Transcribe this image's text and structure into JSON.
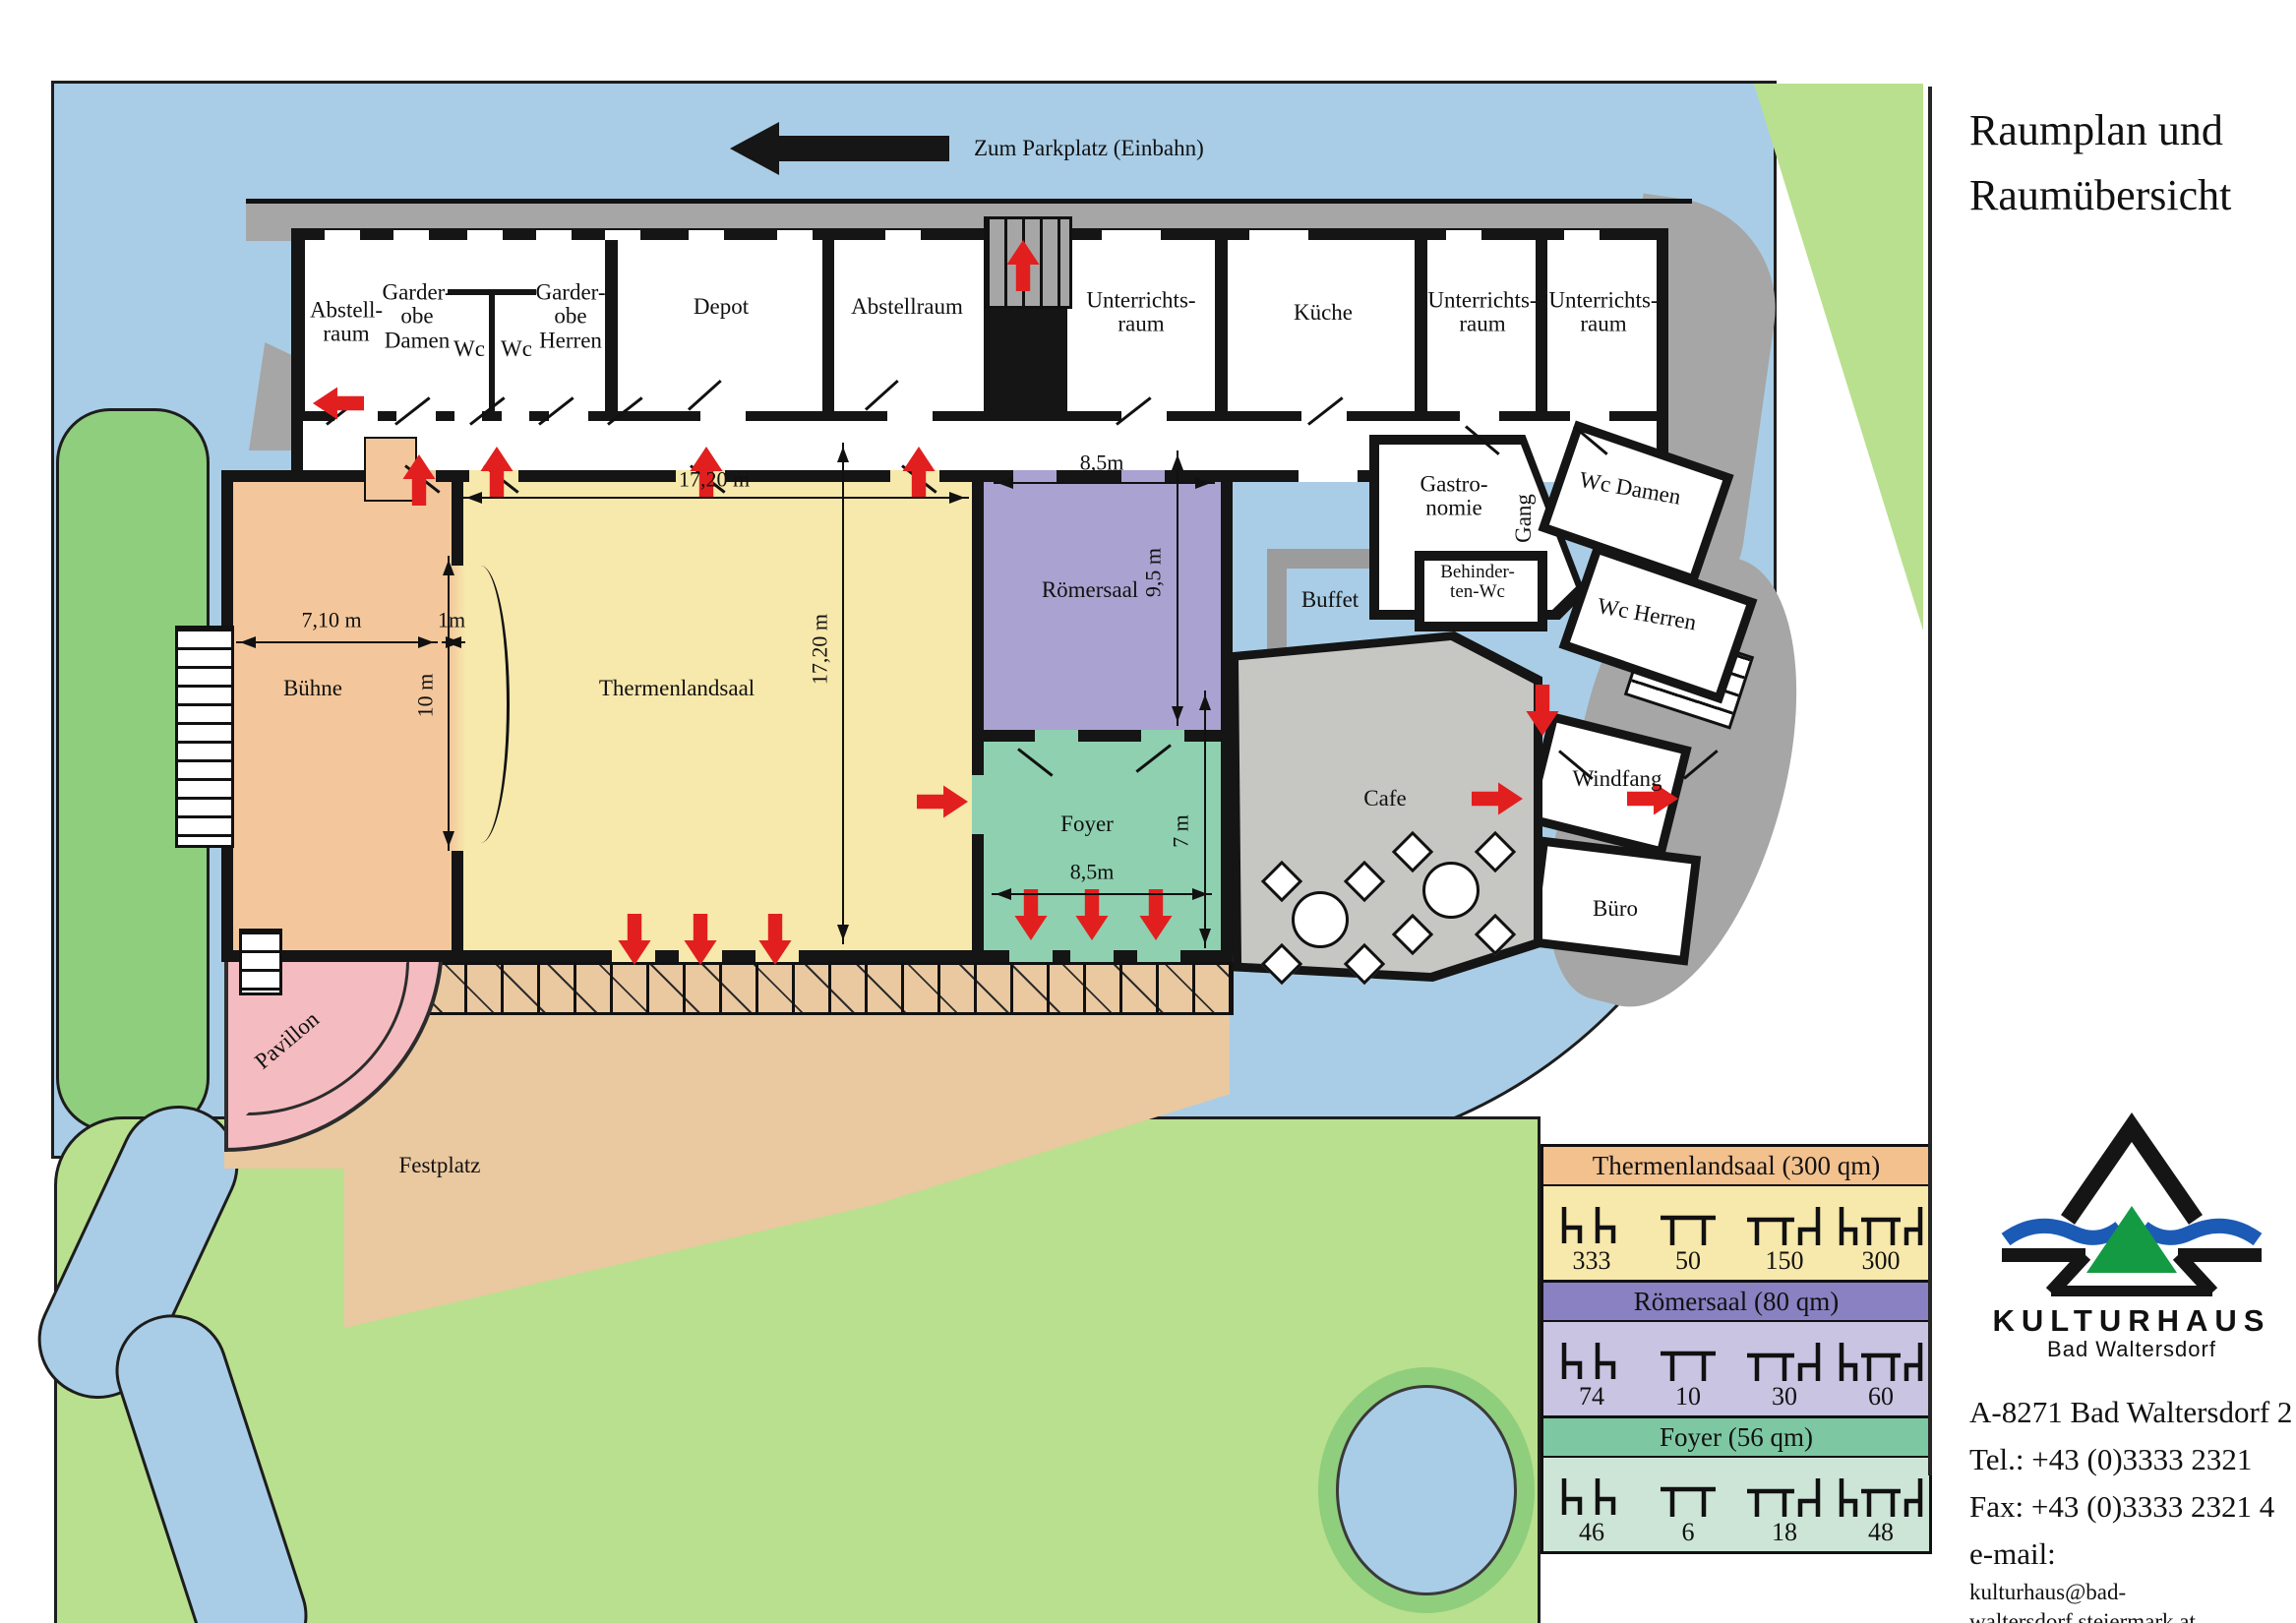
{
  "colors": {
    "water": "#a9cde6",
    "grass": "#8fce7d",
    "grass_light": "#b9e08e",
    "path": "#a6a6a6",
    "cafe": "#c6c6c3",
    "stage": "#f3c79b",
    "hall": "#f7e8ab",
    "roemer": "#aaa2d0",
    "foyer": "#8ed0b0",
    "pink": "#f4bcc0",
    "tan": "#eac8a0",
    "red": "#e21f1f",
    "hall_hdr": "#f2c18e",
    "roemer_hdr": "#8981c1",
    "roemer_body": "#c9c4e2",
    "foyer_hdr": "#7dc7a3",
    "foyer_body": "#cde5d7",
    "logo_blue": "#1c5bb5",
    "logo_green": "#159a44"
  },
  "header": {
    "parking_label": "Zum Parkplatz (Einbahn)"
  },
  "rooms": {
    "abstellraum_1": "Abstell-\nraum",
    "garderobe_damen": "Garder-\nobe\nDamen",
    "wc_1": "Wc",
    "wc_2": "Wc",
    "garderobe_herren": "Garder-\nobe\nHerren",
    "depot": "Depot",
    "abstellraum_2": "Abstellraum",
    "unterrichtsraum_1": "Unterrichts-\nraum",
    "kueche": "Küche",
    "unterrichtsraum_2": "Unterrichts-\nraum",
    "unterrichtsraum_3": "Unterrichts-\nraum",
    "buehne": "Bühne",
    "thermenlandsaal": "Thermenlandsaal",
    "roemersaal": "Römersaal",
    "foyer": "Foyer",
    "buffet": "Buffet",
    "gastronomie": "Gastro-\nnomie",
    "gang": "Gang",
    "wc_damen": "Wc Damen",
    "behinderten_wc": "Behinder-\nten-Wc",
    "wc_herren": "Wc Herren",
    "cafe": "Cafe",
    "windfang": "Windfang",
    "buero": "Büro",
    "pavillon": "Pavillon",
    "festplatz": "Festplatz"
  },
  "dims": {
    "saal_w": "17,20 m",
    "saal_h": "17,20 m",
    "roemer_w": "8,5m",
    "roemer_h": "9,5 m",
    "buehne_w": "7,10 m",
    "proszenium": "1m",
    "buehne_opening": "10 m",
    "foyer_w": "8,5m",
    "foyer_h": "7 m"
  },
  "legend": {
    "icons": [
      "rows-of-chairs",
      "tables",
      "table-with-chair",
      "table-with-chairs"
    ],
    "sections": [
      {
        "title": "Thermenlandsaal (300 qm)",
        "values": [
          "333",
          "50",
          "150",
          "300"
        ]
      },
      {
        "title": "Römersaal (80 qm)",
        "values": [
          "74",
          "10",
          "30",
          "60"
        ]
      },
      {
        "title": "Foyer (56 qm)",
        "values": [
          "46",
          "6",
          "18",
          "48"
        ]
      }
    ]
  },
  "side": {
    "title_line1": "Raumplan und",
    "title_line2": "Raumübersicht",
    "logo_name": "KULTURHAUS",
    "logo_sub": "Bad Waltersdorf",
    "address": "A-8271 Bad Waltersdorf 2",
    "tel": "Tel.: +43 (0)3333 2321",
    "fax": "Fax: +43 (0)3333 2321 4",
    "email_label": "e-mail:",
    "email": "kulturhaus@bad-waltersdorf.steiermark.at"
  }
}
